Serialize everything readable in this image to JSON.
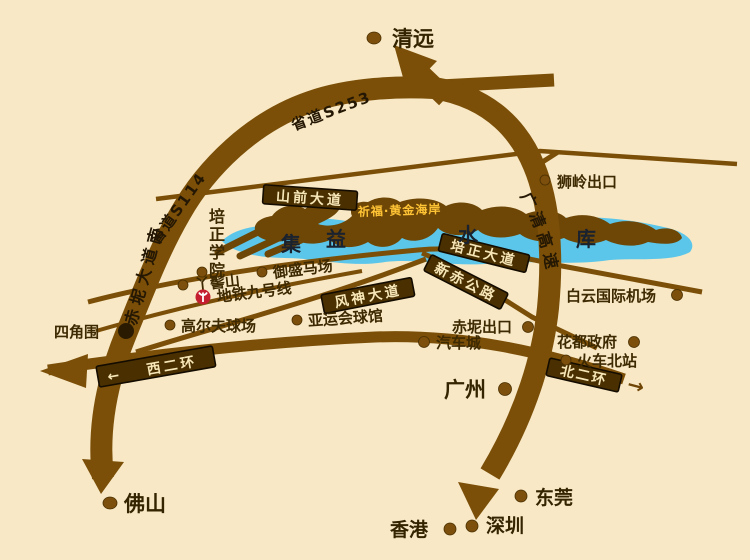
{
  "cities": {
    "qingyuan": "清远",
    "foshan": "佛山",
    "guangzhou": "广州",
    "dongguan": "东莞",
    "shenzhen": "深圳",
    "hongkong": "香港"
  },
  "roads": {
    "s253": "省道S253",
    "s114": "省道S114",
    "chini_ave_south": "赤坭大道南",
    "shanqian_ave": "山前大道",
    "guangqing_expressway": "广清高速",
    "peizheng_ave": "培正大道",
    "xinchi_highway": "新赤公路",
    "fengshen_ave": "风神大道",
    "west_2nd_ring": "西二环",
    "north_2nd_ring": "北二环",
    "metro_line_9": "地铁九号线"
  },
  "pois": {
    "shiling_exit": "狮岭出口",
    "peizheng_college": "培正学院",
    "yaji_mountain": "丫髻山",
    "yusheng_horse_ranch": "御盛马场",
    "golf_course": "高尔夫球场",
    "asian_games_gym": "亚运会球馆",
    "sijiaowei": "四角围",
    "chini_exit": "赤坭出口",
    "auto_city": "汽车城",
    "huadu_government": "花都政府",
    "north_railway_station": "火车北站",
    "baiyun_airport": "白云国际机场"
  },
  "landmark": {
    "project_name": "祈福·黄金海岸",
    "reservoir_name": "集益水库"
  },
  "icons": {
    "arrow_left": "←",
    "arrow_right": "→"
  },
  "colors": {
    "background": "#F8E8C5",
    "road_brown": "#7B4F08",
    "label_band": "#4A3000",
    "band_text": "#F6E6B8",
    "lake_blue": "#5BC6EA",
    "peninsula_brown": "#6E4606",
    "project_gold": "#FFC435",
    "reservoir_text": "#19222E",
    "metro_red": "#C41E2F"
  }
}
